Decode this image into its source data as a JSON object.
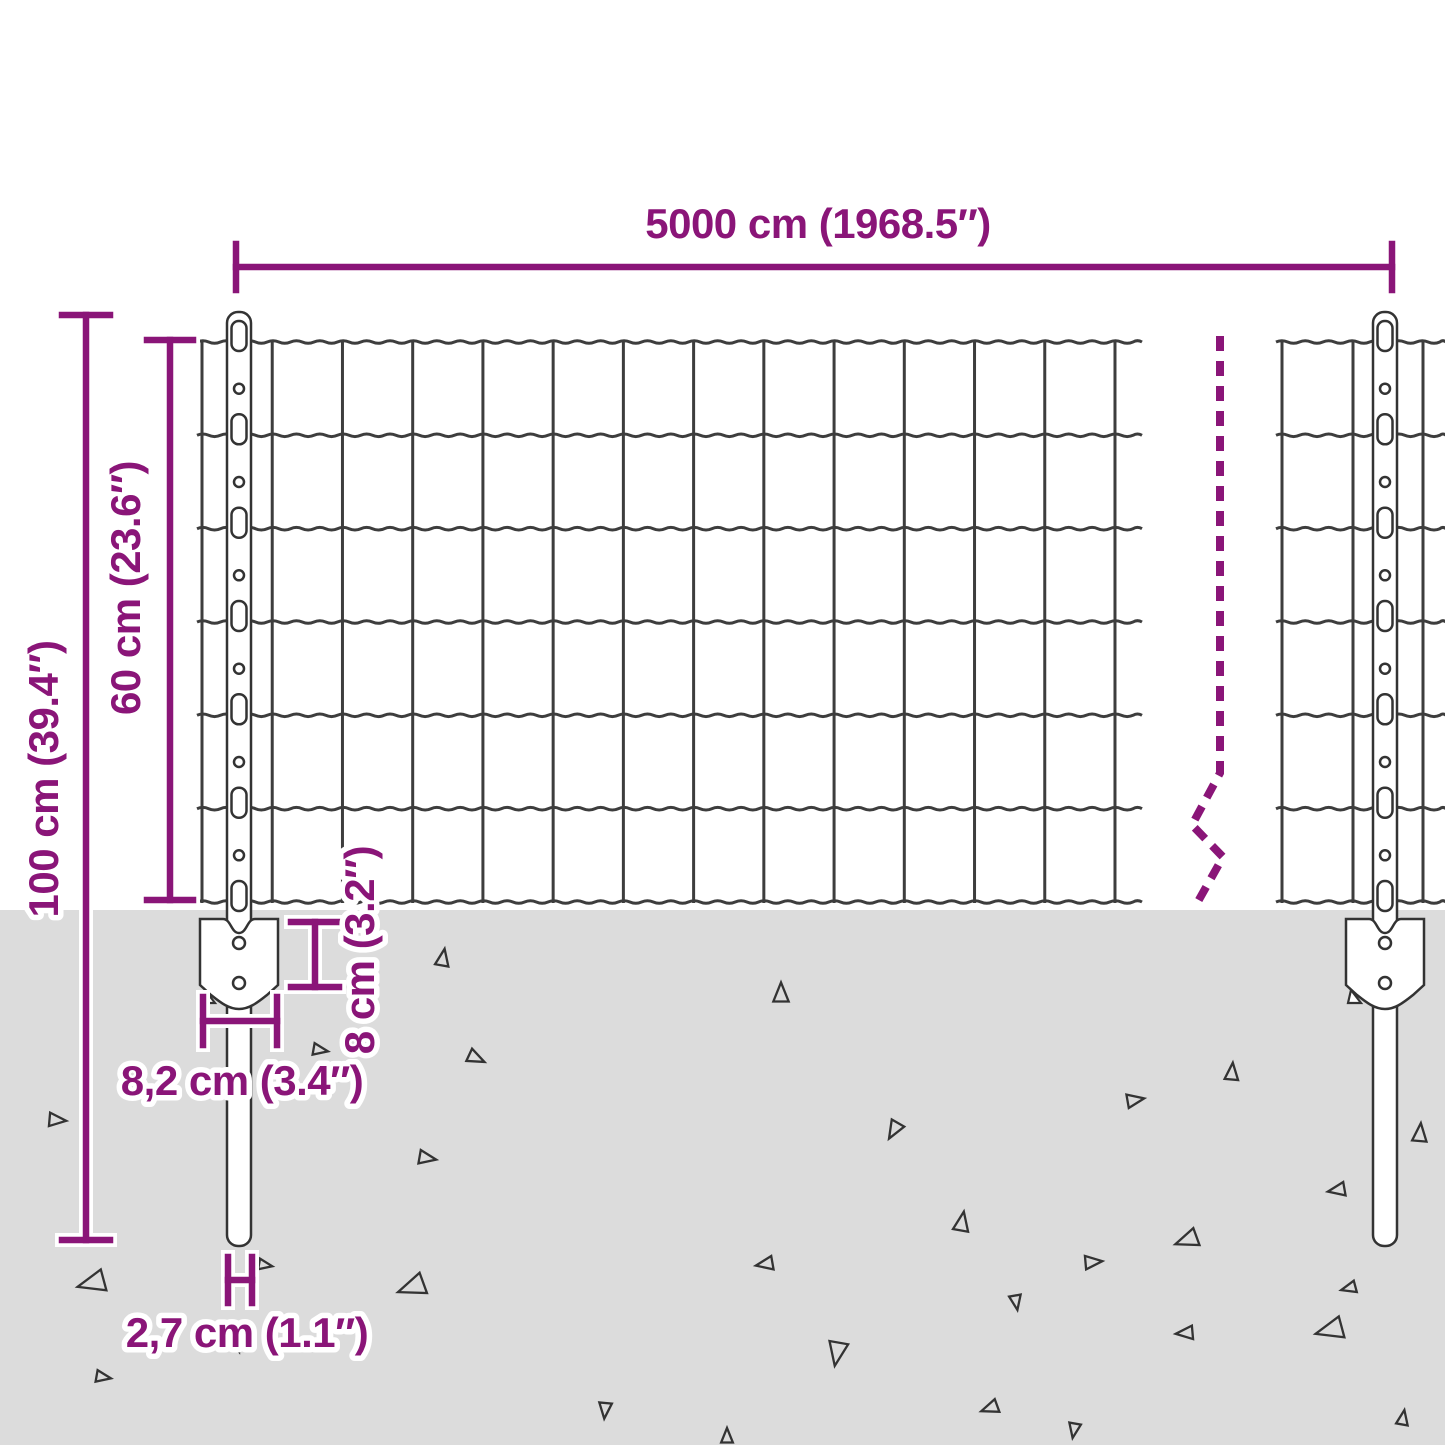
{
  "diagram": {
    "dimensions": {
      "total_width": "5000 cm (1968.5″)",
      "post_height": "100 cm (39.4″)",
      "mesh_height": "60 cm (23.6″)",
      "bracket_depth": "8 cm (3.2″)",
      "bracket_width": "8,2 cm (3.4″)",
      "post_diameter": "2,7 cm (1.1″)"
    },
    "colors": {
      "dimension": "#8A1578",
      "wire": "#3d3d3d",
      "outline": "#333333",
      "fill_white": "#ffffff",
      "ground": "#dcdcdc",
      "halo": "#ffffff",
      "background": "#ffffff"
    }
  }
}
